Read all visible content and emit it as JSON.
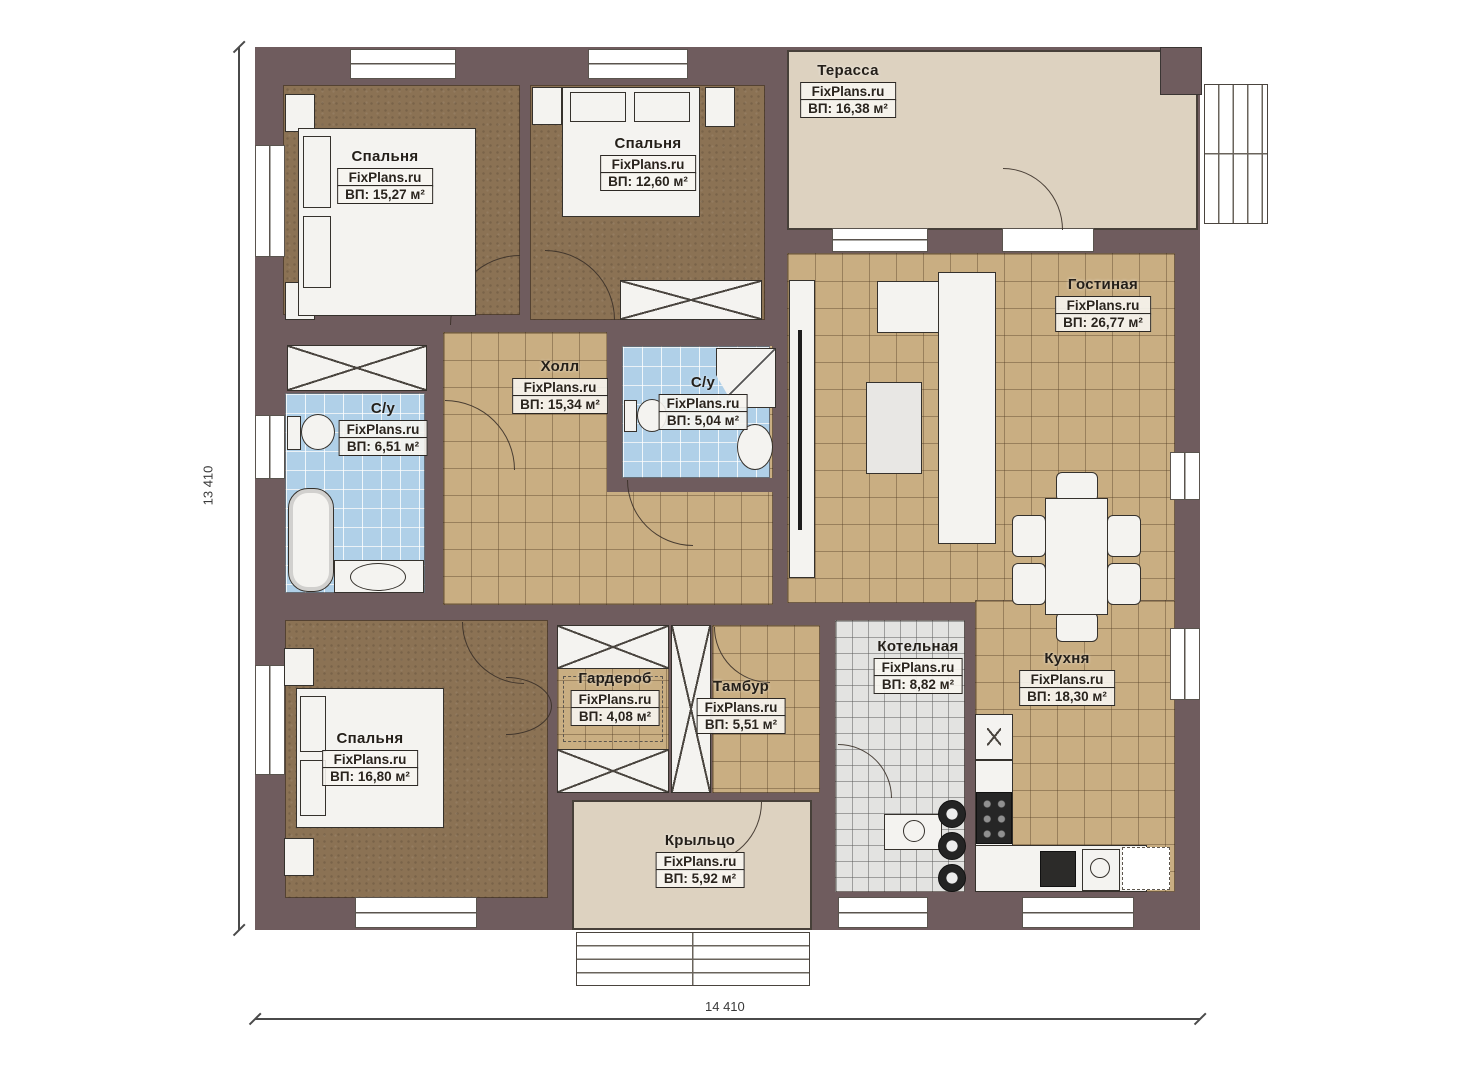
{
  "plan": {
    "watermark": "FixPlans.ru",
    "dimensions": {
      "height_label": "13 410",
      "width_label": "14 410"
    },
    "rooms": [
      {
        "id": "terrace",
        "name": "Терасса",
        "area": "ВП: 16,38 м²"
      },
      {
        "id": "bedroom-1",
        "name": "Спальня",
        "area": "ВП: 15,27 м²"
      },
      {
        "id": "bedroom-2",
        "name": "Спальня",
        "area": "ВП: 12,60 м²"
      },
      {
        "id": "living-room",
        "name": "Гостиная",
        "area": "ВП: 26,77 м²"
      },
      {
        "id": "hall",
        "name": "Холл",
        "area": "ВП: 15,34 м²"
      },
      {
        "id": "bathroom-small",
        "name": "С/у",
        "area": "ВП: 5,04 м²"
      },
      {
        "id": "bathroom-left",
        "name": "С/у",
        "area": "ВП: 6,51 м²"
      },
      {
        "id": "boiler-room",
        "name": "Котельная",
        "area": "ВП: 8,82 м²"
      },
      {
        "id": "kitchen",
        "name": "Кухня",
        "area": "ВП: 18,30 м²"
      },
      {
        "id": "wardrobe",
        "name": "Гардероб",
        "area": "ВП: 4,08 м²"
      },
      {
        "id": "vestibule",
        "name": "Тамбур",
        "area": "ВП: 5,51 м²"
      },
      {
        "id": "bedroom-3",
        "name": "Спальня",
        "area": "ВП: 16,80 м²"
      },
      {
        "id": "porch",
        "name": "Крыльцо",
        "area": "ВП: 5,92 м²"
      }
    ],
    "colors": {
      "wall": "#6f5c5e",
      "floor-tile": "#c9ae82",
      "floor-carpet": "#8b7254",
      "floor-bath": "#b0d0e8",
      "floor-boiler": "#e3e3e1",
      "floor-terrace": "#ddd2c0",
      "furniture": "#f4f3f0"
    }
  }
}
